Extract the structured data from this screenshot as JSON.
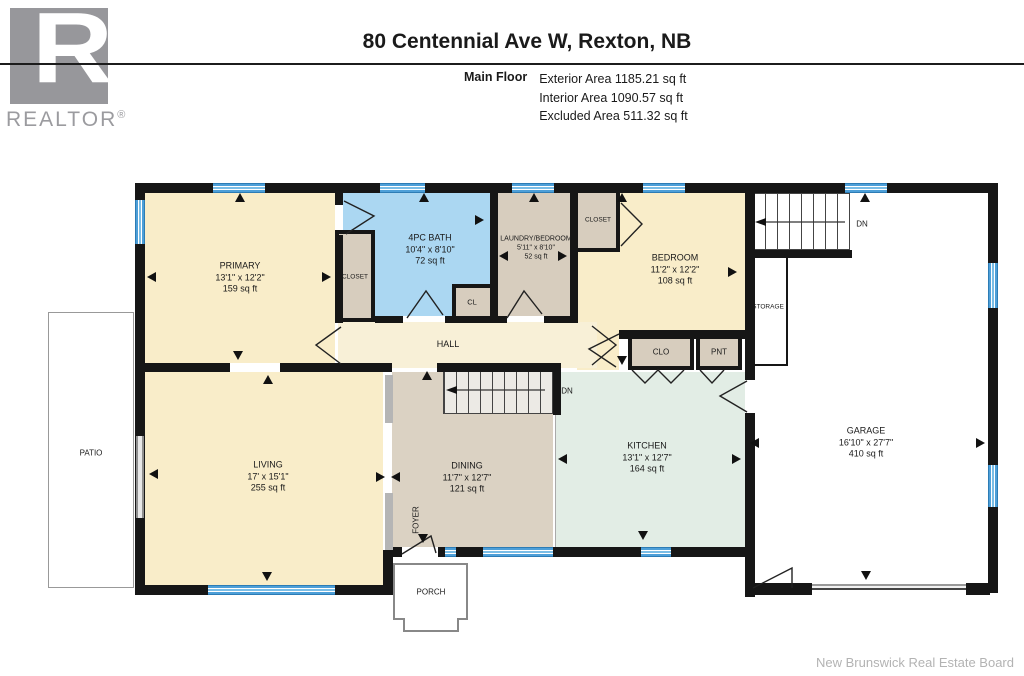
{
  "header": {
    "title": "80 Centennial Ave W, Rexton, NB",
    "floor_label": "Main Floor",
    "stat1": "Exterior Area 1185.21 sq ft",
    "stat2": "Interior Area 1090.57 sq ft",
    "stat3": "Excluded Area 511.32 sq ft"
  },
  "logo": {
    "letter": "R",
    "brand": "REALTOR",
    "reg": "®"
  },
  "rooms": {
    "primary": {
      "name": "PRIMARY",
      "dims": "13'1\" x 12'2\"",
      "area": "159 sq ft"
    },
    "bath": {
      "name": "4PC BATH",
      "dims": "10'4\" x 8'10\"",
      "area": "72 sq ft"
    },
    "laundry": {
      "name": "LAUNDRY/BEDROOM",
      "dims": "5'11\" x 8'10\"",
      "area": "52 sq ft"
    },
    "bedroom": {
      "name": "BEDROOM",
      "dims": "11'2\" x 12'2\"",
      "area": "108 sq ft"
    },
    "living": {
      "name": "LIVING",
      "dims": "17' x 15'1\"",
      "area": "255 sq ft"
    },
    "dining": {
      "name": "DINING",
      "dims": "11'7\" x 12'7\"",
      "area": "121 sq ft"
    },
    "kitchen": {
      "name": "KITCHEN",
      "dims": "13'1\" x 12'7\"",
      "area": "164 sq ft"
    },
    "garage": {
      "name": "GARAGE",
      "dims": "16'10\" x 27'7\"",
      "area": "410 sq ft"
    }
  },
  "labels": {
    "hall": "HALL",
    "closet_primary": "CLOSET",
    "closet_bedroom": "CLOSET",
    "cl": "CL",
    "clo": "CLO",
    "pnt": "PNT",
    "storage": "STORAGE",
    "patio": "PATIO",
    "porch": "PORCH",
    "foyer": "FOYER",
    "dn_upper": "DN",
    "dn_lower": "DN"
  },
  "footer": {
    "credit": "New Brunswick Real Estate Board"
  },
  "colors": {
    "cream": "#F9EDC9",
    "bath_blue": "#ABD7F2",
    "beige": "#D7CDBE",
    "mint": "#E2EDE5",
    "window_blue": "#4D9FD8",
    "wall": "#161616"
  }
}
